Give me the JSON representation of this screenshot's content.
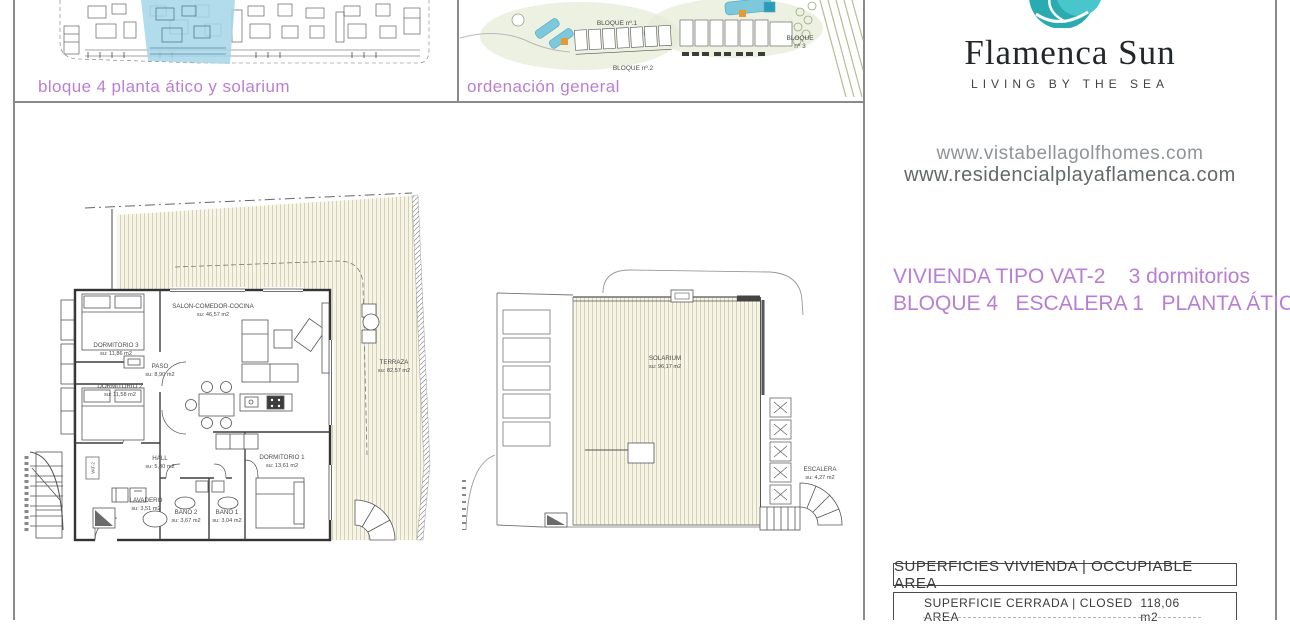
{
  "colors": {
    "accent_pink": "#bb7ed3",
    "teal_dark": "#2aabb0",
    "teal_light": "#49c6cb",
    "highlight_blue": "#a5d5e7",
    "hatch_bg": "#f7f4e8",
    "hatch_line": "#d6d0b6",
    "plan_line": "#4a4a4a"
  },
  "top_panels": {
    "panel1_caption": "bloque 4 planta ático y solarium",
    "panel2_caption": "ordenación general",
    "site_labels": {
      "bloque1": "BLOQUE nº.1",
      "bloque2": "BLOQUE nº.2",
      "bloque3_line1": "BLOQUE",
      "bloque3_line2": "nº 3"
    }
  },
  "brand": {
    "logo_icon": "wave-swirl-icon",
    "name": "Flamenca Sun",
    "tagline": "LIVING BY THE SEA",
    "websites": [
      "www.vistabellagolfhomes.com",
      "www.residencialplayaflamenca.com"
    ]
  },
  "unit_info": {
    "type": "VIVIENDA TIPO VAT-2",
    "bedrooms": "3 dormitorios",
    "location": "BLOQUE 4   ESCALERA 1   PLANTA ÁTICO"
  },
  "areas": {
    "header": "SUPERFICIES VIVIENDA | OCCUPIABLE AREA",
    "rows": [
      {
        "label": "SUPERFICIE CERRADA | CLOSED AREA",
        "value": "118,06 m2"
      }
    ]
  },
  "floorplan_left": {
    "entrance_tag": "VAT-2",
    "rooms": [
      {
        "name": "SALON-COMEDOR-COCINA",
        "area": "su: 46,57 m2"
      },
      {
        "name": "DORMITORIO 3",
        "area": "su: 11,86 m2"
      },
      {
        "name": "PASO",
        "area": "su: 8,90 m2"
      },
      {
        "name": "DORMITORIO 2",
        "area": "su: 11,58 m2"
      },
      {
        "name": "HALL",
        "area": "su: 5,80 m2"
      },
      {
        "name": "DORMITORIO 1",
        "area": "su: 13,61 m2"
      },
      {
        "name": "LAVADERO",
        "area": "su: 3,51 m2"
      },
      {
        "name": "BAÑO 2",
        "area": "su: 3,67 m2"
      },
      {
        "name": "BAÑO 1",
        "area": "su: 3,04 m2"
      },
      {
        "name": "TERRAZA",
        "area": "su: 82,57 m2"
      }
    ]
  },
  "floorplan_right": {
    "rooms": [
      {
        "name": "SOLARIUM",
        "area": "su: 96,17 m2"
      },
      {
        "name": "ESCALERA",
        "area": "su: 4,27 m2"
      }
    ]
  }
}
